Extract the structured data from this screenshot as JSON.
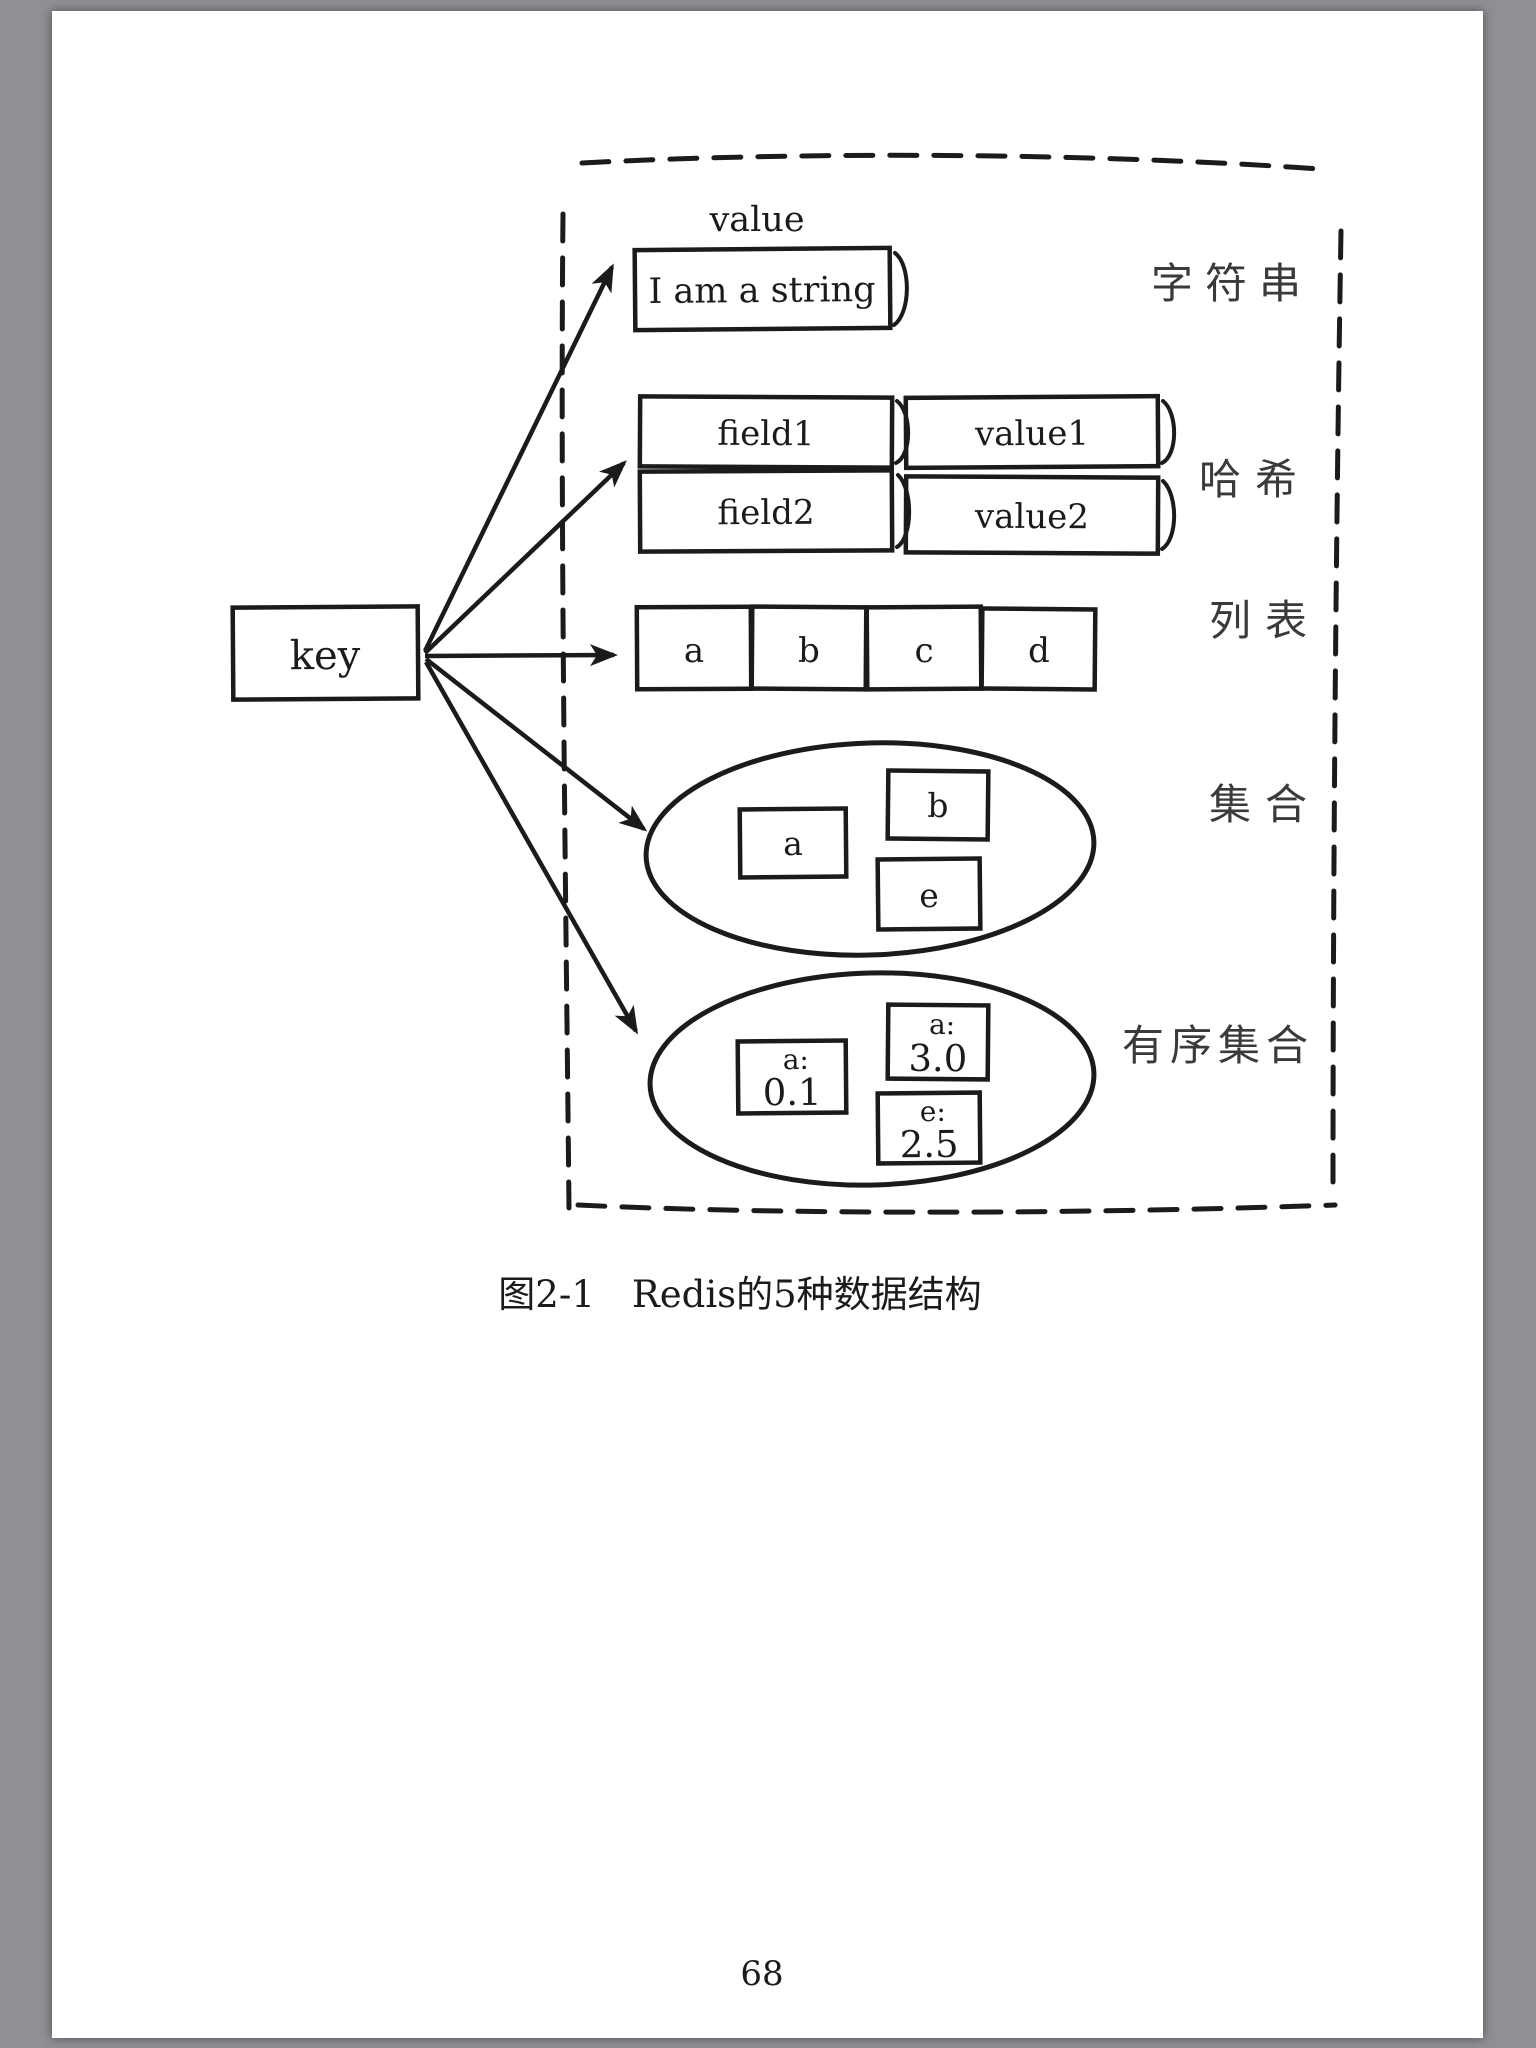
{
  "viewer": {
    "background_color": "#8f8f94",
    "paper_color": "#ffffff"
  },
  "page": {
    "number": "68",
    "caption": "图2-1　Redis的5种数据结构"
  },
  "diagram": {
    "ink_color": "#1b1b1b",
    "key_label": "key",
    "value_label": "value",
    "string": {
      "type_label": "字符串",
      "content": "I am a string"
    },
    "hash": {
      "type_label": "哈希",
      "rows": [
        {
          "field": "field1",
          "value": "value1"
        },
        {
          "field": "field2",
          "value": "value2"
        }
      ]
    },
    "list": {
      "type_label": "列表",
      "items": [
        "a",
        "b",
        "c",
        "d"
      ]
    },
    "set": {
      "type_label": "集合",
      "members": [
        "a",
        "b",
        "e"
      ]
    },
    "sorted_set": {
      "type_label": "有序集合",
      "members": [
        {
          "member": "a:",
          "score": "0.1"
        },
        {
          "member": "a:",
          "score": "3.0"
        },
        {
          "member": "e:",
          "score": "2.5"
        }
      ]
    }
  }
}
